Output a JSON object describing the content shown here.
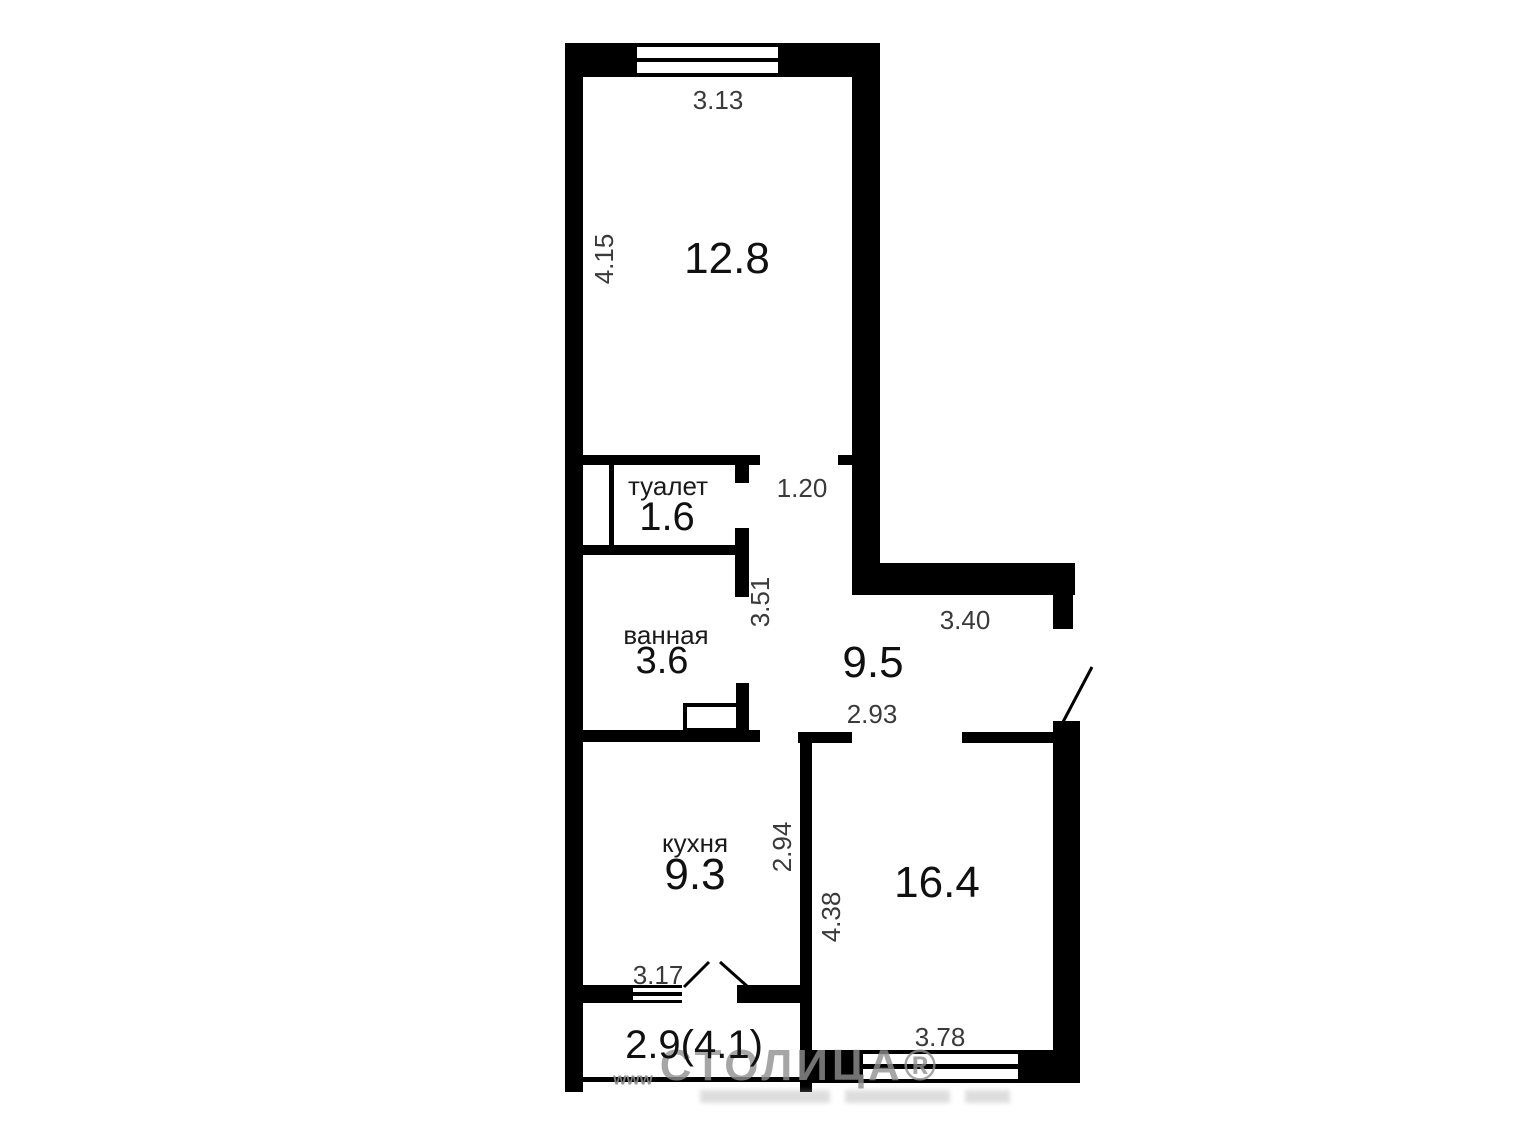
{
  "rooms": {
    "living": {
      "area": "12.8"
    },
    "toilet": {
      "name": "туалет",
      "area": "1.6"
    },
    "bathroom": {
      "name": "ванная",
      "area": "3.6"
    },
    "hallway": {
      "area": "9.5"
    },
    "kitchen": {
      "name": "кухня",
      "area": "9.3"
    },
    "room": {
      "area": "16.4"
    },
    "balcony": {
      "area": "2.9(4.1)"
    }
  },
  "dimensions": {
    "living_width": "3.13",
    "living_depth": "4.15",
    "hall_opening": "1.20",
    "hall_depth": "3.51",
    "hall_width": "3.40",
    "hall_lower_width": "2.93",
    "kitchen_depth": "2.94",
    "kitchen_window": "3.17",
    "room_depth": "4.38",
    "room_window": "3.78"
  },
  "watermark": {
    "text": "СТОЛИЦА®",
    "prefix": "www"
  },
  "colors": {
    "wall": "#000000",
    "area_text": "#101010",
    "dim_text": "#3a3a3a",
    "watermark": "#909090"
  }
}
